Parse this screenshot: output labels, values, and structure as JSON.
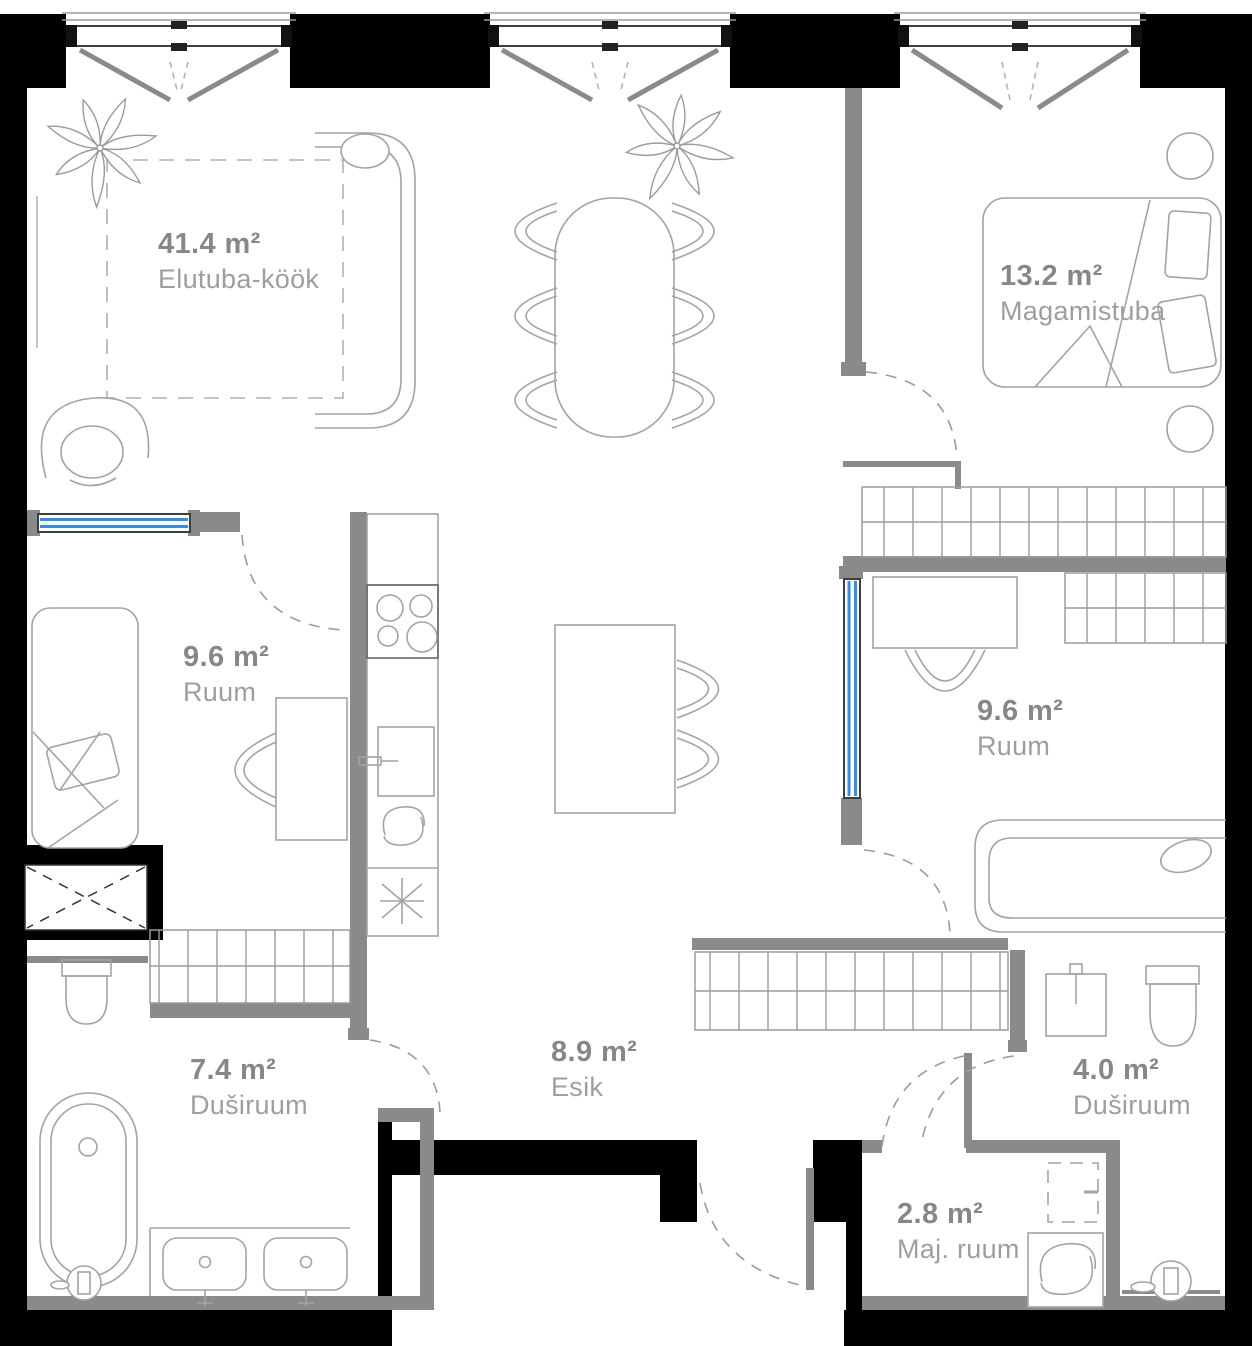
{
  "plan": {
    "title": "Apartment floor plan",
    "rooms": [
      {
        "id": "elutuba-kook",
        "area": "41.4 m²",
        "name": "Elutuba-köök"
      },
      {
        "id": "magamistuba",
        "area": "13.2 m²",
        "name": "Magamistuba"
      },
      {
        "id": "ruum-left",
        "area": "9.6 m²",
        "name": "Ruum"
      },
      {
        "id": "ruum-right",
        "area": "9.6 m²",
        "name": "Ruum"
      },
      {
        "id": "dusiruum-left",
        "area": "7.4 m²",
        "name": "Duširuum"
      },
      {
        "id": "esik",
        "area": "8.9 m²",
        "name": "Esik"
      },
      {
        "id": "dusiruum-right",
        "area": "4.0 m²",
        "name": "Duširuum"
      },
      {
        "id": "maj-ruum",
        "area": "2.8 m²",
        "name": "Maj. ruum"
      }
    ],
    "colors": {
      "exterior_wall": "#000000",
      "interior_wall": "#8a8a8a",
      "window_glass": "#2f8ef5",
      "furniture_line": "#a3a3a3",
      "label_area": "#84888b",
      "label_name": "#9b9fa2"
    }
  }
}
